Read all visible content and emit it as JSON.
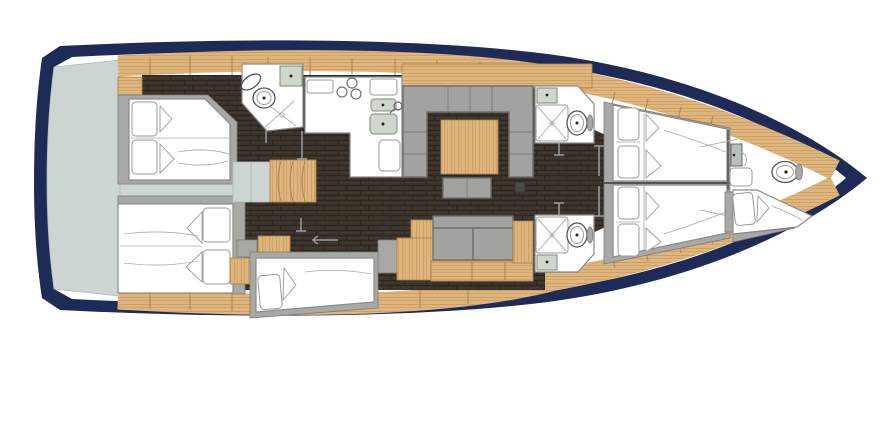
{
  "meta": {
    "title": "Sailing yacht interior layout plan, bow to the right",
    "view": "top-down deck plan"
  },
  "palette": {
    "hull_navy": "#1e2b57",
    "deck_white": "#ffffff",
    "transom_pale": "#ccd5d1",
    "wood_light": "#deb57d",
    "wood_grain": "#c79a5f",
    "wood_edge": "#ad8450",
    "floor_dark": "#3a322a",
    "floor_streak_dark": "#2c2620",
    "floor_streak_light": "#4a4034",
    "frame_gray": "#a8a8a5",
    "sofa_gray": "#a2a2a0",
    "sink_green": "#ced7ca",
    "fixture_white": "#ffffff",
    "outline_gray": "#8a8a8a"
  },
  "areas": [
    {
      "id": "hull",
      "label": "Hull outline, bow pointing right"
    },
    {
      "id": "swim-platform",
      "label": "Transom / stern platform"
    },
    {
      "id": "aft-cabin-top",
      "label": "Aft double cabin (top)",
      "beds": 1,
      "pillows": 2
    },
    {
      "id": "aft-cabin-bottom",
      "label": "Aft double cabin (bottom)",
      "beds": 1,
      "pillows": 2
    },
    {
      "id": "aft-head",
      "label": "Aft head with shower",
      "fixtures": [
        "washbasin",
        "toilet",
        "shower"
      ]
    },
    {
      "id": "companionway",
      "label": "Companionway steps with landing",
      "steps": 4
    },
    {
      "id": "galley",
      "label": "Galley",
      "fixtures": [
        "3-burner stove",
        "double sink",
        "worktop"
      ]
    },
    {
      "id": "salon",
      "label": "Salon with U-shaped sofa and table"
    },
    {
      "id": "settee",
      "label": "Straight settee with lockers (bottom)"
    },
    {
      "id": "single-berth",
      "label": "Single berth amidships (bottom)",
      "beds": 1,
      "pillows": 1
    },
    {
      "id": "mid-head-top",
      "label": "Mid head with shower (top)",
      "fixtures": [
        "washbasin",
        "shower",
        "toilet"
      ]
    },
    {
      "id": "mid-head-bottom",
      "label": "Mid head with shower (bottom)",
      "fixtures": [
        "washbasin",
        "shower",
        "toilet"
      ]
    },
    {
      "id": "fore-cabin-top",
      "label": "Forward double cabin (top)",
      "beds": 1,
      "pillows": 2
    },
    {
      "id": "fore-cabin-bottom",
      "label": "Forward double cabin (bottom)",
      "beds": 1,
      "pillows": 2
    },
    {
      "id": "fore-peak",
      "label": "Fore-peak berth and head",
      "fixtures": [
        "toilet",
        "berth"
      ]
    }
  ]
}
